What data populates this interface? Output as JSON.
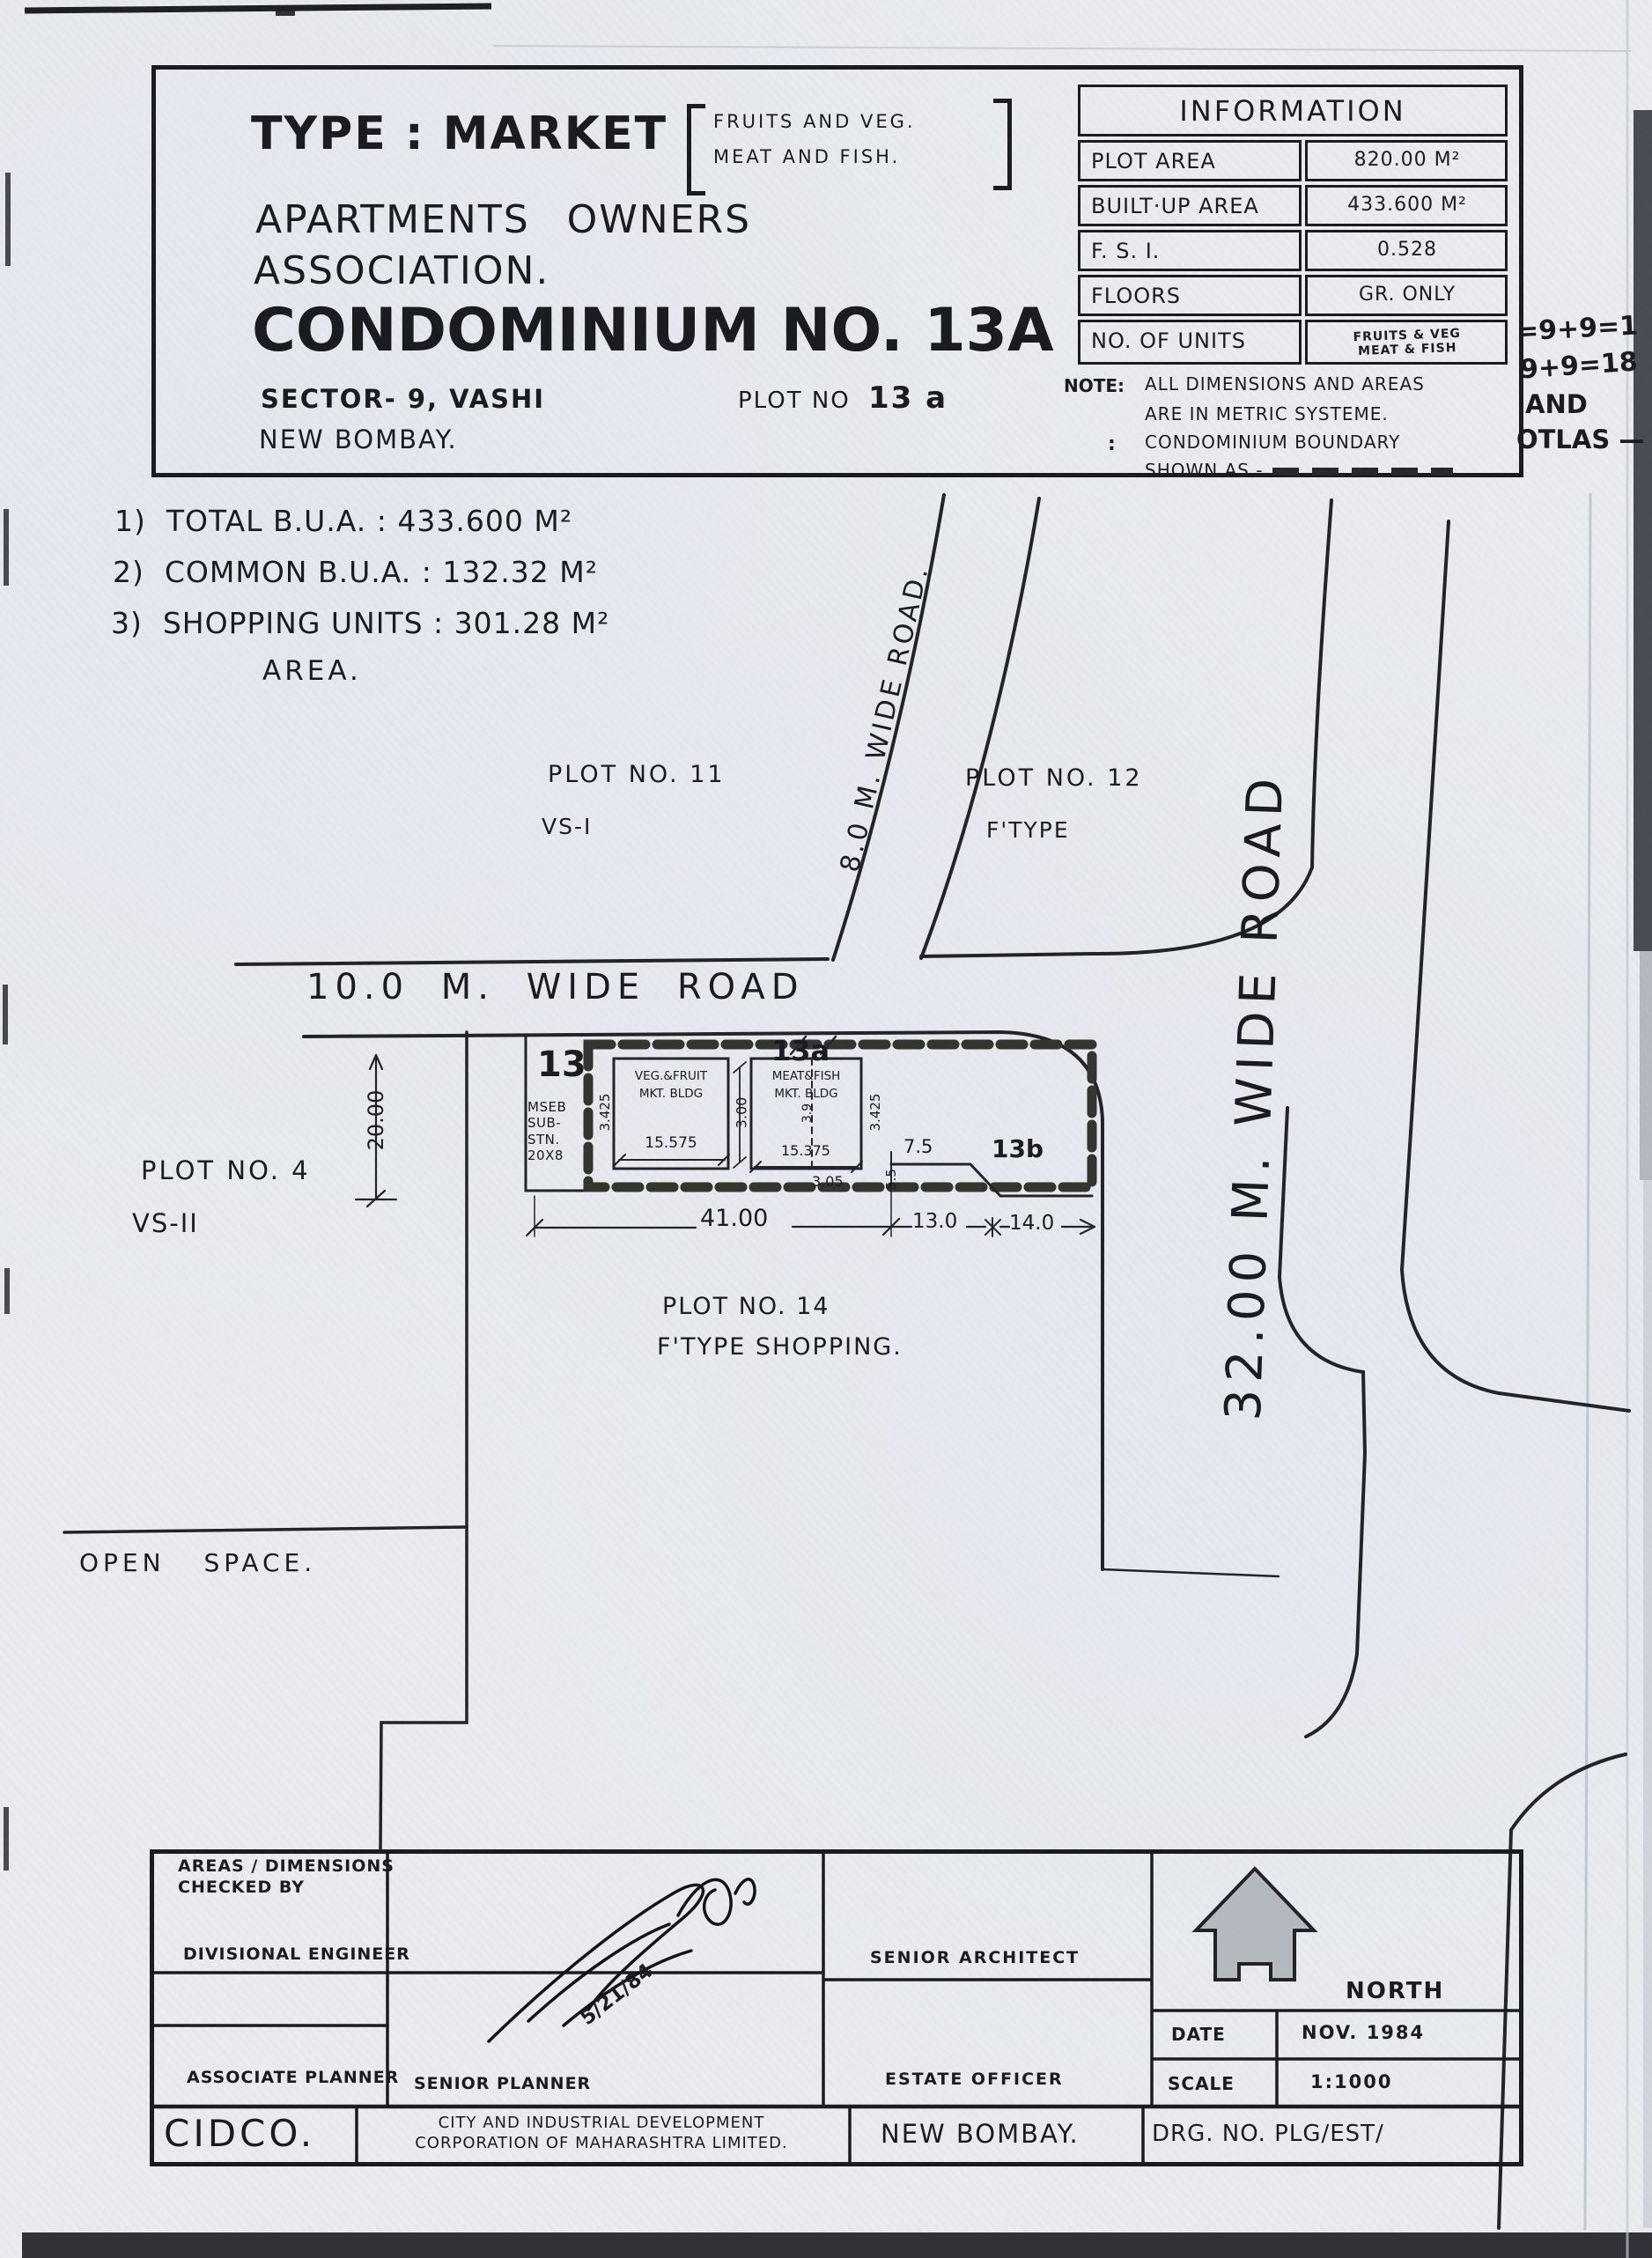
{
  "header": {
    "type_label": "TYPE : MARKET",
    "bracket1": "FRUITS AND VEG.",
    "bracket2": "MEAT AND FISH.",
    "org1": "APARTMENTS OWNERS",
    "org2": "ASSOCIATION.",
    "condo": "CONDOMINIUM NO. 13A",
    "sector": "SECTOR- 9, VASHI",
    "plot_label": "PLOT NO",
    "plot_value": "13 a",
    "city": "NEW BOMBAY."
  },
  "info": {
    "title": "INFORMATION",
    "rows": [
      {
        "label": "PLOT AREA",
        "value": "820.00 M²"
      },
      {
        "label": "BUILT·UP AREA",
        "value": "433.600 M²"
      },
      {
        "label": "F. S. I.",
        "value": "0.528"
      },
      {
        "label": "FLOORS",
        "value": "GR. ONLY"
      },
      {
        "label": "NO. OF UNITS",
        "value": ""
      }
    ],
    "units1": "FRUITS & VEG",
    "units2": "MEAT & FISH"
  },
  "note": {
    "label": "NOTE:",
    "l1": "ALL DIMENSIONS AND AREAS",
    "l2": "ARE IN METRIC SYSTEME.",
    "colon": ":",
    "l3": "CONDOMINIUM BOUNDARY",
    "l4": "SHOWN AS -"
  },
  "hand": {
    "h1": "=9+9=1",
    "h2": "9+9=18",
    "h3": "AND",
    "h4": "OTLAS —"
  },
  "bua": {
    "items": [
      {
        "num": "1)",
        "text": "TOTAL B.U.A. : 433.600 M²"
      },
      {
        "num": "2)",
        "text": "COMMON B.U.A. : 132.32 M²"
      },
      {
        "num": "3)",
        "text": "SHOPPING UNITS : 301.28 M²"
      }
    ],
    "suffix": "AREA."
  },
  "site": {
    "road10": "10.0 M. WIDE ROAD",
    "road8": "8.0 M. WIDE ROAD.",
    "road32": "32.00 M. WIDE ROAD",
    "p11": "PLOT NO. 11",
    "p11t": "VS-I",
    "p12": "PLOT NO. 12",
    "p12t": "F'TYPE",
    "p4": "PLOT NO. 4",
    "p4t": "VS-II",
    "p14": "PLOT NO. 14",
    "p14t": "F'TYPE SHOPPING.",
    "open": "OPEN SPACE.",
    "n13": "13",
    "mseb": "MSEB\nSUB-\nSTN.\n20X8",
    "l13a": "13a",
    "l13b": "13b",
    "b1a": "VEG.&FRUIT",
    "b1b": "MKT. BLDG",
    "b1d": "15.575",
    "b2a": "MEAT&FISH",
    "b2b": "MKT. BLDG",
    "b2d": "15.375",
    "d3425L": "3.425",
    "d300": "3.00",
    "d39": "3.9",
    "d3425R": "3.425",
    "d75": "7.5",
    "d55": "5.5",
    "d305": "3.05",
    "d4100": "41.00",
    "d130": "13.0",
    "d140": "14.0",
    "d2000": "20.00"
  },
  "tb": {
    "checked1": "AREAS / DIMENSIONS",
    "checked2": "CHECKED BY",
    "div_eng": "DIVISIONAL ENGINEER",
    "assoc_plan": "ASSOCIATE PLANNER",
    "sen_plan": "SENIOR PLANNER",
    "sen_arch": "SENIOR ARCHITECT",
    "est_off": "ESTATE OFFICER",
    "north": "NORTH",
    "date_l": "DATE",
    "date_v": "NOV. 1984",
    "scale_l": "SCALE",
    "scale_v": "1:1000",
    "cidco": "CIDCO.",
    "corp1": "CITY AND INDUSTRIAL DEVELOPMENT",
    "corp2": "CORPORATION OF MAHARASHTRA LIMITED.",
    "city": "NEW BOMBAY.",
    "drg": "DRG. NO. PLG/EST/",
    "sig_date": "5/21/84"
  },
  "colors": {
    "ink": "#1b1c20",
    "paper": "#e9ebef",
    "boundary": "#32362f",
    "north_fill": "#a3a8b0"
  }
}
